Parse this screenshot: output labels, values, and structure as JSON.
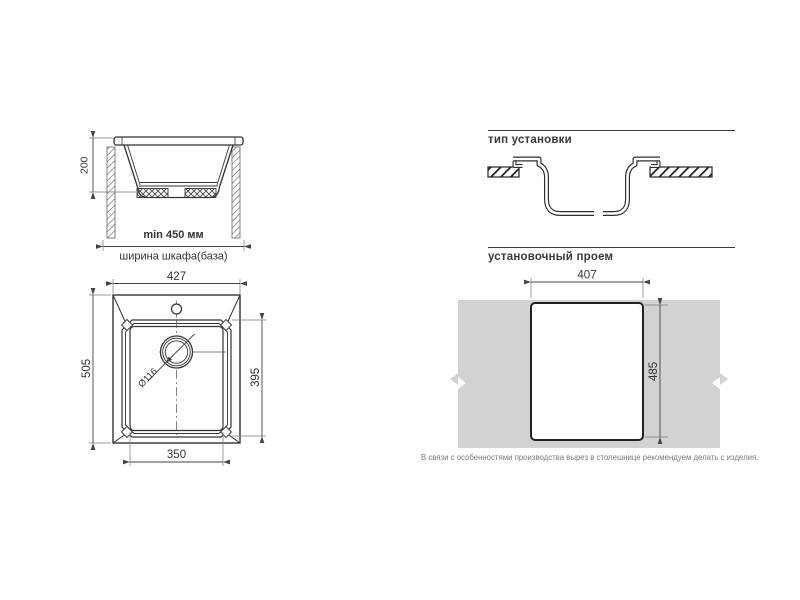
{
  "side_view": {
    "depth_dim": "200",
    "min_width": "min 450 мм",
    "cabinet_caption": "ширина шкафа(база)"
  },
  "installation_type": {
    "title": "тип установки"
  },
  "top_view": {
    "overall_width": "427",
    "overall_depth": "505",
    "bowl_depth": "395",
    "bowl_width": "350",
    "drain_diameter": "Ø116"
  },
  "cutout": {
    "title": "установочный проем",
    "width": "407",
    "height": "485",
    "note": "В связи с особенностями производства вырез в столешнице рекомендуем делать с изделия."
  },
  "colors": {
    "line": "#333333",
    "dim": "#444444",
    "extension": "#777777",
    "countertop_fill": "#d2d2d2",
    "note": "#7a7a7a"
  }
}
